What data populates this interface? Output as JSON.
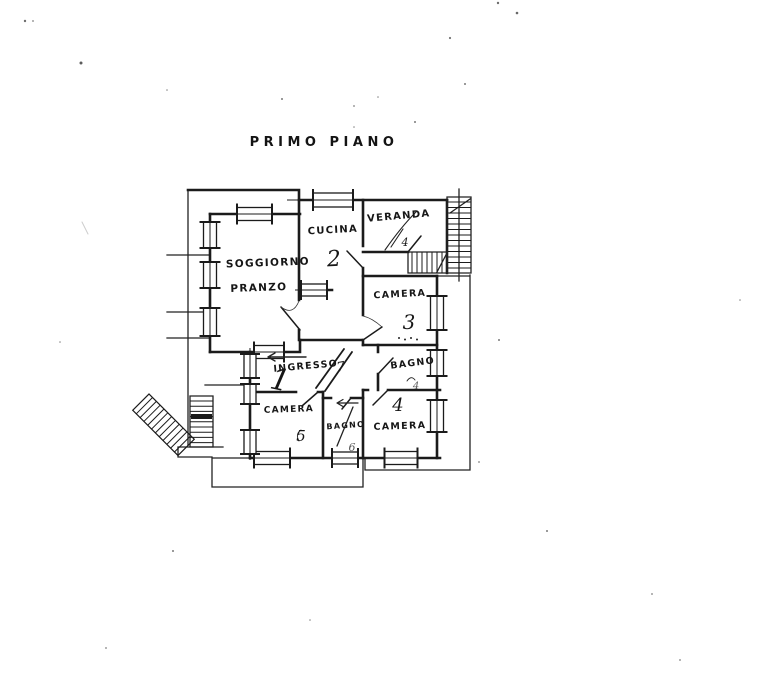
{
  "title": "PRIMO PIANO",
  "ink_color": "#1b1b1b",
  "paper_color": "#ffffff",
  "rooms": {
    "soggiorno_pranzo": {
      "label_line1": "SOGGIORNO",
      "label_line2": "PRANZO",
      "number": "1"
    },
    "cucina": {
      "label": "CUCINA",
      "number": "2"
    },
    "veranda": {
      "label": "VERANDA",
      "annotation": "4"
    },
    "camera_3": {
      "label": "CAMERA",
      "number": "3"
    },
    "bagno_camera": {
      "label": "BAGNO",
      "annotation": "4"
    },
    "camera_4": {
      "label": "CAMERA",
      "number": "4"
    },
    "camera_5": {
      "label": "CAMERA",
      "number": "5"
    },
    "bagno_piccolo": {
      "label": "BAGNO",
      "number": "6"
    },
    "ingresso": {
      "label": "INGRESSO",
      "number": "7"
    }
  }
}
